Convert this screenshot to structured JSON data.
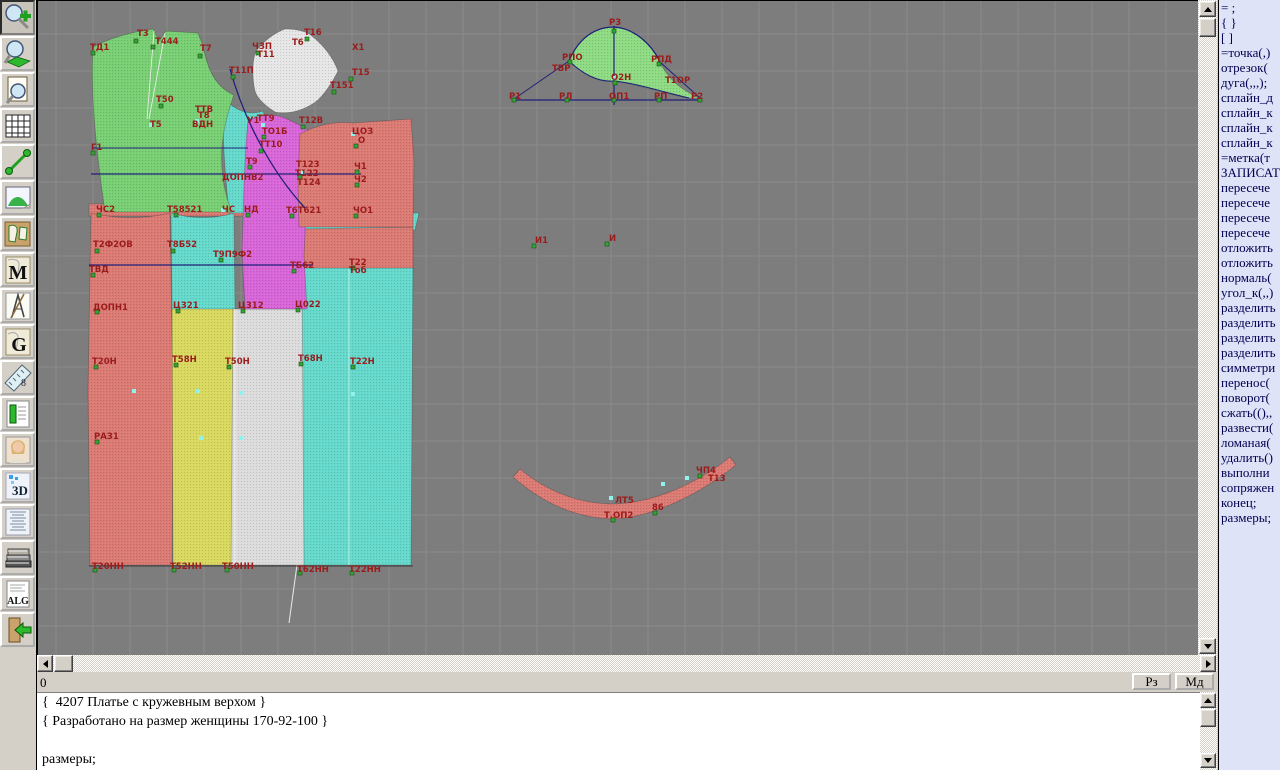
{
  "colors": {
    "canvas_bg": "#7d7d7d",
    "panel_bg": "#d4d0c8",
    "right_panel_bg": "#dfe3f8",
    "label_red": "#9b1c1c",
    "construction_navy": "#20207a",
    "accent_green": "#2db82d"
  },
  "toolbar": {
    "items": [
      {
        "id": "zoom-in"
      },
      {
        "id": "zoom-fit"
      },
      {
        "id": "print-preview"
      },
      {
        "id": "grid"
      },
      {
        "id": "segment"
      },
      {
        "id": "picture"
      },
      {
        "id": "patterns"
      },
      {
        "id": "marking-m"
      },
      {
        "id": "design-tools"
      },
      {
        "id": "grading-g"
      },
      {
        "id": "ruler"
      },
      {
        "id": "table"
      },
      {
        "id": "model-photo"
      },
      {
        "id": "view-3d"
      },
      {
        "id": "text-list"
      },
      {
        "id": "library"
      },
      {
        "id": "algorithms"
      },
      {
        "id": "exit"
      }
    ],
    "glyphs": {
      "m": "M",
      "g": "G",
      "threed": "3D",
      "alg": "ALG",
      "eight": "8"
    }
  },
  "statusbar": {
    "left_text": "0",
    "buttons": [
      "Рз",
      "Мд"
    ]
  },
  "editor": {
    "lines": [
      "{  4207 Платье с кружевным верхом }",
      "{ Разработано на размер женщины 170-92-100 }",
      "",
      "размеры;"
    ]
  },
  "right_panel": {
    "lines": [
      "= ;",
      "{ }",
      "[ ]",
      "=точка(,)",
      "отрезок(",
      "дуга(,,,);",
      "сплайн_д",
      "сплайн_к",
      "сплайн_к",
      "сплайн_к",
      "=метка(т",
      "ЗАПИСАТ",
      "пересече",
      "пересече",
      "пересече",
      "пересече",
      "отложить",
      "отложить",
      "нормаль(",
      "угол_к(,,)",
      "разделить",
      "разделить",
      "разделить",
      "разделить",
      "симметри",
      "перенос(",
      "поворот(",
      "сжать((),,",
      "развести(",
      "ломаная(",
      "удалить()",
      "выполни",
      "сопряжен",
      "конец;",
      "размеры;"
    ]
  },
  "canvas": {
    "pieces": [
      {
        "name": "waistband-red",
        "color": "#dc7a74",
        "path": "M88,203 L322,203 L322,215 L88,215 Z"
      },
      {
        "name": "cyan-strip",
        "color": "#66d9cd",
        "path": "M299,213 L418,212 L414,229 L298,229 Z"
      },
      {
        "name": "yoke-red",
        "color": "#dc7a74",
        "path": "M296,228 L412,226 L412,269 L298,269 Z"
      },
      {
        "name": "skirt-red-left",
        "color": "#dc7a74",
        "path": "M90,212 C115,218 145,218 169,212 L172,390 L171,564 L89,564 L87,390 Z"
      },
      {
        "name": "skirt-cyan-left",
        "color": "#66d9cd",
        "path": "M170,212 C190,218 214,218 233,212 L234,310 L171,310 Z"
      },
      {
        "name": "skirt-yellow",
        "color": "#d9d960",
        "path": "M171,308 L234,308 L234,564 L172,564 Z"
      },
      {
        "name": "skirt-gray",
        "color": "#dcdcdc",
        "path": "M232,308 L305,308 L306,564 L230,564 Z"
      },
      {
        "name": "skirt-cyan-right",
        "color": "#66d9cd",
        "path": "M301,267 L412,267 L410,564 L303,564 Z"
      },
      {
        "name": "gore-cyan",
        "color": "#66d9cd",
        "path": "M222,96 C234,110 248,115 262,110 L268,126 C262,162 260,188 262,212 L228,212 C224,172 221,134 222,96 Z"
      },
      {
        "name": "bodice-front-green",
        "color": "#79cf74",
        "path": "M92,46 C103,40 120,34 135,31 L152,28 L158,40 L165,30 L197,32 L202,45 C207,70 215,86 233,94 C225,115 219,142 221,167 C222,184 226,199 231,211 L104,211 C96,155 89,94 92,46 Z"
      },
      {
        "name": "center-panel-magenta",
        "color": "#d966d9",
        "path": "M247,120 C260,113 276,112 288,119 L305,127 C311,133 313,142 311,152 L305,210 L303,255 L306,308 L244,308 L241,250 L243,185 C244,160 245,138 247,120 Z"
      },
      {
        "name": "bodice-back-red",
        "color": "#dc7a74",
        "path": "M299,133 C315,124 334,120 352,122 L410,118 L413,160 L412,226 L298,226 L297,180 Z"
      },
      {
        "name": "lace-top-white",
        "color": "#e6e6e6",
        "path": "M284,28 C295,28 306,30 312,36 C322,44 332,56 337,70 C331,82 324,92 317,99 C306,108 290,114 274,111 C263,104 256,97 254,90 C251,77 251,60 255,50 C263,40 273,32 284,28 Z"
      },
      {
        "name": "sleeve-cap-green",
        "color": "#8fdb84",
        "path": "M568,60 C578,36 595,26 613,26 C632,27 650,42 659,61 C665,75 678,88 698,97 L686,97 C655,90 630,82 613,80 C596,82 580,72 568,60 Z"
      },
      {
        "name": "collar-band-red",
        "color": "#dc7a74",
        "path": "M512,476 C545,505 580,518 615,518 C655,515 700,492 735,464 L729,456 C697,482 655,501 614,503 C580,503 548,492 519,468 Z"
      }
    ],
    "lines": [
      {
        "d": "M92,147 L247,147",
        "s": "#20207a",
        "w": 1
      },
      {
        "d": "M90,173 L360,173",
        "s": "#20207a",
        "w": 1.2
      },
      {
        "d": "M88,264 L312,264",
        "s": "#20207a",
        "w": 1.2
      },
      {
        "d": "M513,99 L700,99",
        "s": "#20207a",
        "w": 1.2
      },
      {
        "d": "M613,25 L613,104",
        "s": "#20207a",
        "w": 1.2
      },
      {
        "d": "M513,98 L568,60",
        "s": "#20207a",
        "w": 1
      },
      {
        "d": "M700,98 L659,61",
        "s": "#20207a",
        "w": 1
      },
      {
        "d": "M568,60 C578,36 595,26 613,26 C632,27 650,42 659,61",
        "s": "#20207a",
        "w": 1.2
      },
      {
        "d": "M568,60 C585,76 600,81 613,80 C634,82 658,90 688,97",
        "s": "#20207a",
        "w": 1
      },
      {
        "d": "M229,68 C242,115 268,168 304,207",
        "s": "#20207a",
        "w": 1.3
      },
      {
        "d": "M296,564 C292,592 290,608 288,622",
        "s": "#e8e8e8",
        "w": 1
      },
      {
        "d": "M153,30 L146,118",
        "s": "#f0f0f0",
        "w": 0.8
      },
      {
        "d": "M164,32 L148,118",
        "s": "#f0f0f0",
        "w": 0.8
      },
      {
        "d": "M88,565 L412,565",
        "s": "#3c3c3c",
        "w": 1
      },
      {
        "d": "M348,268 L348,564",
        "s": "rgba(255,255,255,0.55)",
        "w": 1
      },
      {
        "d": "M234,308 L234,564",
        "s": "rgba(255,255,255,0.55)",
        "w": 1
      }
    ],
    "markers": {
      "green": [
        [
          92,
          52
        ],
        [
          135,
          40
        ],
        [
          152,
          46
        ],
        [
          199,
          55
        ],
        [
          160,
          105
        ],
        [
          92,
          152
        ],
        [
          232,
          76
        ],
        [
          306,
          38
        ],
        [
          350,
          78
        ],
        [
          333,
          91
        ],
        [
          257,
          52
        ],
        [
          302,
          126
        ],
        [
          263,
          136
        ],
        [
          260,
          150
        ],
        [
          355,
          145
        ],
        [
          299,
          176
        ],
        [
          356,
          171
        ],
        [
          356,
          184
        ],
        [
          249,
          166
        ],
        [
          98,
          214
        ],
        [
          175,
          214
        ],
        [
          247,
          214
        ],
        [
          291,
          215
        ],
        [
          355,
          215
        ],
        [
          96,
          250
        ],
        [
          172,
          250
        ],
        [
          220,
          259
        ],
        [
          92,
          274
        ],
        [
          293,
          270
        ],
        [
          352,
          267
        ],
        [
          96,
          311
        ],
        [
          177,
          310
        ],
        [
          242,
          310
        ],
        [
          297,
          309
        ],
        [
          95,
          366
        ],
        [
          175,
          364
        ],
        [
          228,
          366
        ],
        [
          300,
          363
        ],
        [
          352,
          366
        ],
        [
          96,
          441
        ],
        [
          94,
          569
        ],
        [
          173,
          569
        ],
        [
          226,
          569
        ],
        [
          299,
          572
        ],
        [
          351,
          572
        ],
        [
          513,
          99
        ],
        [
          566,
          99
        ],
        [
          613,
          99
        ],
        [
          658,
          99
        ],
        [
          699,
          99
        ],
        [
          613,
          30
        ],
        [
          569,
          61
        ],
        [
          658,
          63
        ],
        [
          533,
          245
        ],
        [
          606,
          243
        ],
        [
          612,
          519
        ],
        [
          654,
          512
        ],
        [
          699,
          475
        ],
        [
          614,
          82
        ]
      ],
      "cyan": [
        [
          150,
          124
        ],
        [
          196,
          120
        ],
        [
          133,
          390
        ],
        [
          197,
          390
        ],
        [
          240,
          392
        ],
        [
          352,
          393
        ],
        [
          200,
          437
        ],
        [
          240,
          437
        ],
        [
          610,
          497
        ],
        [
          262,
          124
        ],
        [
          352,
          133
        ],
        [
          612,
          77
        ],
        [
          662,
          483
        ],
        [
          686,
          477
        ],
        [
          302,
          171
        ],
        [
          222,
          209
        ]
      ]
    },
    "labels": [
      {
        "t": "ТД1",
        "x": 89,
        "y": 49
      },
      {
        "t": "Т3",
        "x": 136,
        "y": 35
      },
      {
        "t": "Т444",
        "x": 154,
        "y": 43
      },
      {
        "t": "Т7",
        "x": 199,
        "y": 50
      },
      {
        "t": "Т50",
        "x": 155,
        "y": 101
      },
      {
        "t": "Т5",
        "x": 149,
        "y": 126
      },
      {
        "t": "Г1",
        "x": 90,
        "y": 149
      },
      {
        "t": "ТТВ",
        "x": 194,
        "y": 111
      },
      {
        "t": "Т8",
        "x": 197,
        "y": 117
      },
      {
        "t": "ВДН",
        "x": 191,
        "y": 126
      },
      {
        "t": "Т11П",
        "x": 228,
        "y": 72
      },
      {
        "t": "ЧЗП",
        "x": 251,
        "y": 48
      },
      {
        "t": "Т11",
        "x": 256,
        "y": 56
      },
      {
        "t": "Т6",
        "x": 291,
        "y": 44
      },
      {
        "t": "Т16",
        "x": 303,
        "y": 34
      },
      {
        "t": "Х1",
        "x": 351,
        "y": 49
      },
      {
        "t": "Т15",
        "x": 351,
        "y": 74
      },
      {
        "t": "Т151",
        "x": 329,
        "y": 87
      },
      {
        "t": "Т12В",
        "x": 298,
        "y": 122
      },
      {
        "t": "У1",
        "x": 246,
        "y": 122
      },
      {
        "t": "ТТ9",
        "x": 256,
        "y": 120
      },
      {
        "t": "ТО1Б",
        "x": 261,
        "y": 133
      },
      {
        "t": "ТТ10",
        "x": 258,
        "y": 146
      },
      {
        "t": "ЦОЗ",
        "x": 351,
        "y": 133
      },
      {
        "t": "О",
        "x": 357,
        "y": 142
      },
      {
        "t": "ДОПНВ2",
        "x": 221,
        "y": 179
      },
      {
        "t": "Т123",
        "x": 295,
        "y": 166
      },
      {
        "t": "Т122",
        "x": 294,
        "y": 175
      },
      {
        "t": "Т124",
        "x": 296,
        "y": 184
      },
      {
        "t": "Ч1",
        "x": 353,
        "y": 168
      },
      {
        "t": "Ч2",
        "x": 353,
        "y": 181
      },
      {
        "t": "Т9",
        "x": 245,
        "y": 163
      },
      {
        "t": "ЧС2",
        "x": 95,
        "y": 211
      },
      {
        "t": "Т58521",
        "x": 166,
        "y": 211
      },
      {
        "t": "ЧС",
        "x": 221,
        "y": 211
      },
      {
        "t": "НД",
        "x": 243,
        "y": 211
      },
      {
        "t": "Т6Т621",
        "x": 285,
        "y": 212
      },
      {
        "t": "ЧО1",
        "x": 352,
        "y": 212
      },
      {
        "t": "Т2Ф2ОВ",
        "x": 92,
        "y": 246
      },
      {
        "t": "Т8Б52",
        "x": 166,
        "y": 246
      },
      {
        "t": "Т9П9Ф2",
        "x": 212,
        "y": 256
      },
      {
        "t": "ТВД",
        "x": 88,
        "y": 271
      },
      {
        "t": "ТБ62",
        "x": 289,
        "y": 267
      },
      {
        "t": "Т22",
        "x": 348,
        "y": 264
      },
      {
        "t": "Тоб",
        "x": 348,
        "y": 272
      },
      {
        "t": "ДОПН1",
        "x": 92,
        "y": 309
      },
      {
        "t": "Ц321",
        "x": 172,
        "y": 307
      },
      {
        "t": "Ц312",
        "x": 237,
        "y": 307
      },
      {
        "t": "Ц022",
        "x": 294,
        "y": 306
      },
      {
        "t": "Т20Н",
        "x": 91,
        "y": 363
      },
      {
        "t": "Т58Н",
        "x": 171,
        "y": 361
      },
      {
        "t": "Т50Н",
        "x": 224,
        "y": 363
      },
      {
        "t": "Т68Н",
        "x": 297,
        "y": 360
      },
      {
        "t": "Т22Н",
        "x": 349,
        "y": 363
      },
      {
        "t": "РАЗ1",
        "x": 93,
        "y": 438
      },
      {
        "t": "Т20НН",
        "x": 91,
        "y": 568
      },
      {
        "t": "Т52НН",
        "x": 169,
        "y": 568
      },
      {
        "t": "Т50НН",
        "x": 221,
        "y": 568
      },
      {
        "t": "Т62НН",
        "x": 296,
        "y": 571
      },
      {
        "t": "Т22НН",
        "x": 348,
        "y": 571
      },
      {
        "t": "Р3",
        "x": 608,
        "y": 24
      },
      {
        "t": "РПО",
        "x": 561,
        "y": 59
      },
      {
        "t": "ТВР",
        "x": 551,
        "y": 70
      },
      {
        "t": "РПД",
        "x": 650,
        "y": 61
      },
      {
        "t": "О2Н",
        "x": 610,
        "y": 79
      },
      {
        "t": "Т1ОР",
        "x": 664,
        "y": 82
      },
      {
        "t": "Р1",
        "x": 508,
        "y": 98
      },
      {
        "t": "РЛ",
        "x": 558,
        "y": 98
      },
      {
        "t": "ОП1",
        "x": 608,
        "y": 98
      },
      {
        "t": "РП",
        "x": 653,
        "y": 98
      },
      {
        "t": "Р2",
        "x": 690,
        "y": 98
      },
      {
        "t": "И1",
        "x": 534,
        "y": 242
      },
      {
        "t": "И",
        "x": 608,
        "y": 240
      },
      {
        "t": "ЧП4",
        "x": 695,
        "y": 472
      },
      {
        "t": "Т13",
        "x": 707,
        "y": 480
      },
      {
        "t": "ЛТ5",
        "x": 614,
        "y": 502
      },
      {
        "t": "Т.ОП2",
        "x": 603,
        "y": 517
      },
      {
        "t": "86",
        "x": 651,
        "y": 509
      }
    ]
  }
}
